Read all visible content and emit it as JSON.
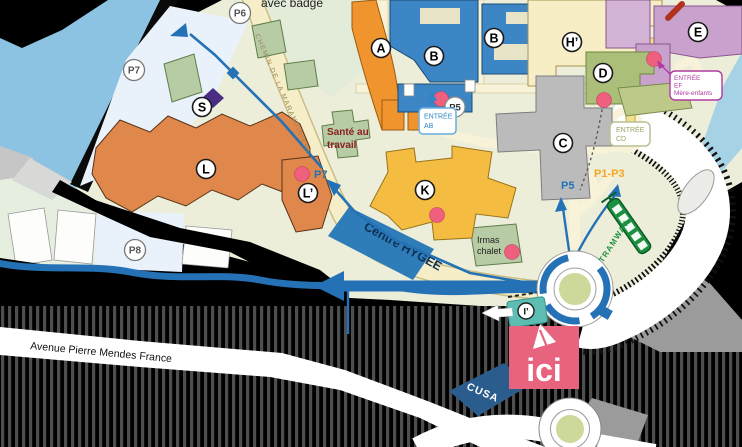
{
  "map": {
    "note_top": "avec badge",
    "roads": {
      "chemin": "CHEMIN DE LA MARANDINIERE",
      "avenue": "Avenue Pierre Mendes France"
    },
    "transit": {
      "tramway": "TRAMWAY"
    },
    "buildings": {
      "a": "A",
      "b1": "B",
      "b2": "B",
      "c": "C",
      "d": "D",
      "e": "E",
      "h_prime": "H’",
      "k": "K",
      "l": "L",
      "l_prime": "L’",
      "s": "S",
      "i_prime": "I’"
    },
    "parkings": {
      "p5": "P5",
      "p6": "P6",
      "p7": "P7",
      "p8": "P8"
    },
    "route_labels": {
      "p5": "P5",
      "p7": "P7",
      "p1_p3": "P1-P3"
    },
    "entrances": {
      "ab": {
        "line1": "ENTRÉE",
        "line2": "AB"
      },
      "cd": {
        "line1": "ENTRÉE",
        "line2": "CD"
      },
      "ef": {
        "line1": "ENTRÉE",
        "line2": "EF",
        "line3": "Mère-enfants"
      }
    },
    "places": {
      "centre_hygee": "Centre HYGÉE",
      "cusa": "CUSA",
      "sante_line1": "Santé au",
      "sante_line2": "travail",
      "irmas_line1": "Irmas",
      "irmas_line2": "chalet",
      "here_marker": "ici"
    },
    "colors": {
      "route_blue": "#2472b5",
      "here_pink": "#e8647e",
      "tram_green": "#1d9040",
      "hygee_blue": "#2e7cb8",
      "cusa_navy": "#2b5c8e",
      "poi_pink": "#ee607e",
      "campus_cream": "#edeeda"
    }
  }
}
